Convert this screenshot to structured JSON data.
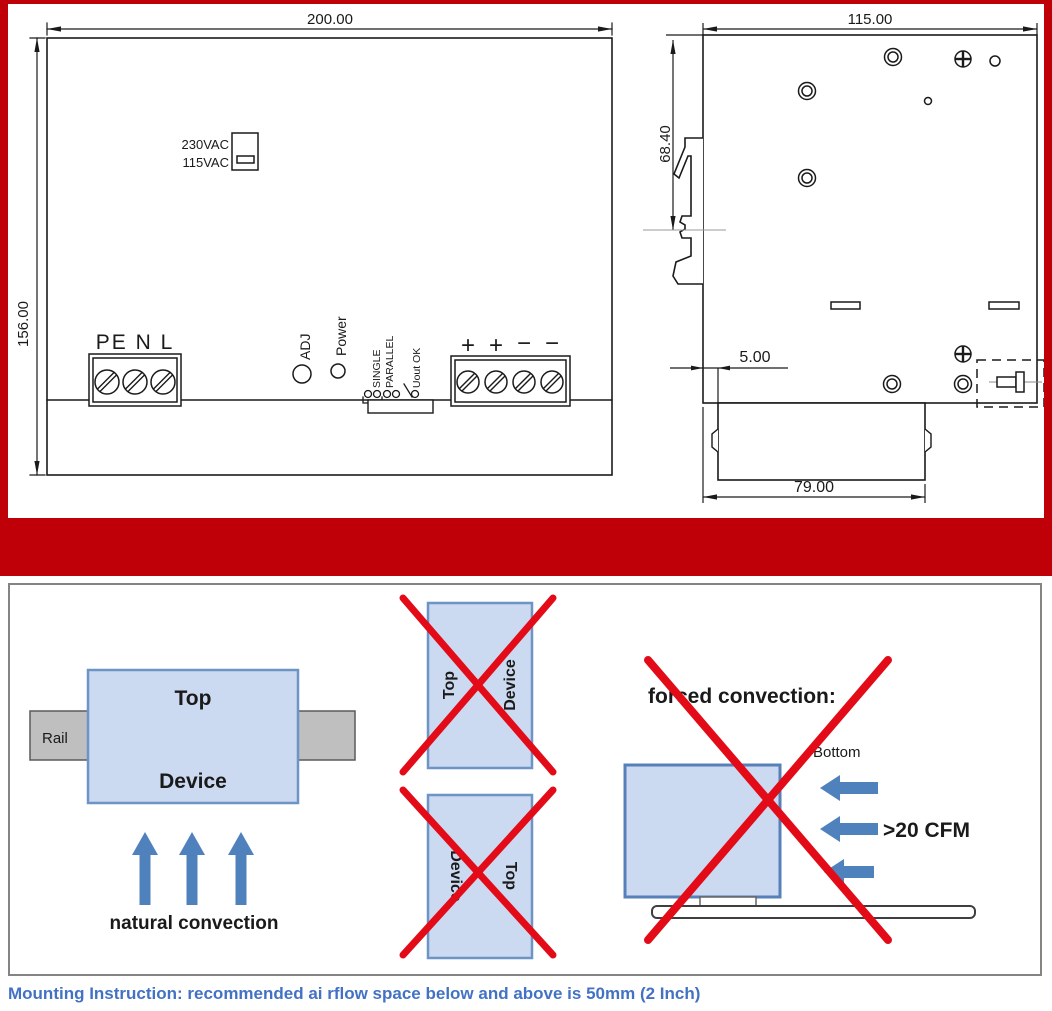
{
  "front_view": {
    "width_dim": "200.00",
    "height_dim": "156.00",
    "voltage_high": "230VAC",
    "voltage_low": "115VAC",
    "input_labels": "PE N L",
    "adj_label": "ADJ",
    "power_label": "Power",
    "single_label": "SINGLE",
    "parallel_label": "PARALLEL",
    "uout_ok_label": "Uout OK",
    "output_terminals": [
      "+",
      "+",
      "−",
      "−"
    ]
  },
  "side_view": {
    "width_dim": "115.00",
    "clip_dim": "68.40",
    "gap_dim": "5.00",
    "bottom_dim": "79.00"
  },
  "mounting": {
    "rail_label": "Rail",
    "top_label": "Top",
    "device_label": "Device",
    "natural_label": "natural convection",
    "forced_label": "forced convection:",
    "bottom_label": "Bottom",
    "cfm_label": ">20 CFM",
    "caption": "Mounting Instruction: recommended ai rflow space below and above is 50mm (2 Inch)"
  },
  "colors": {
    "accent_red": "#bf0008",
    "cross_red": "#e30b17",
    "device_fill": "#cbd9f1",
    "device_border": "#6c94c4",
    "arrow_blue": "#4f81bd",
    "text_navy": "#17375e",
    "caption_blue": "#4372c5",
    "rail_gray": "#bfbfbf"
  }
}
